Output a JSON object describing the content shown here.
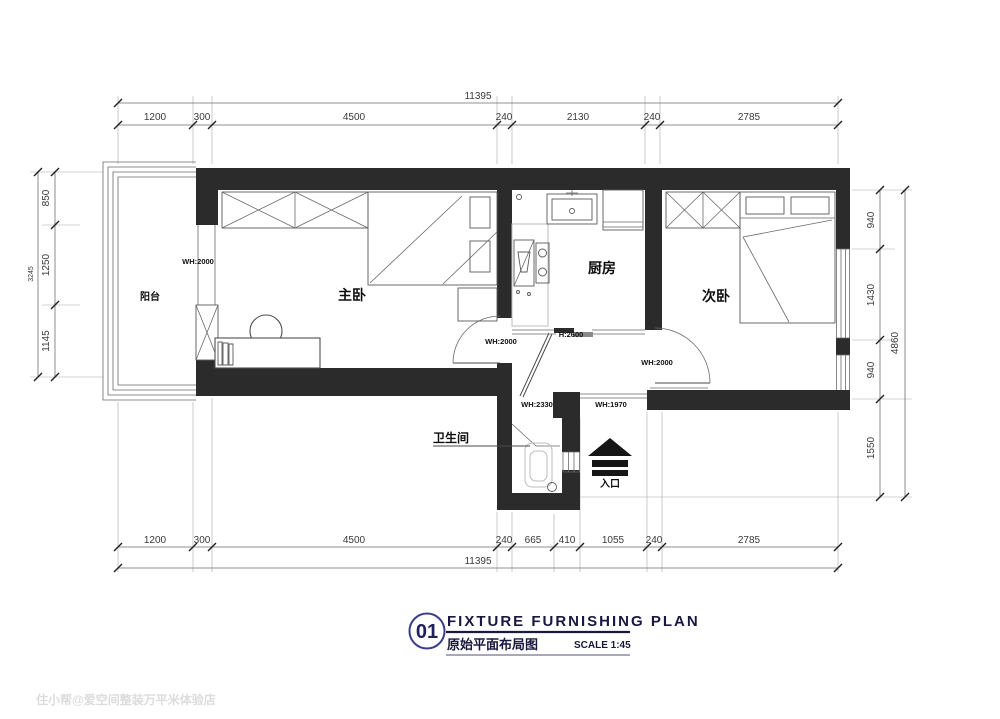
{
  "title_block": {
    "number": "01",
    "title_en": "FIXTURE FURNISHING PLAN",
    "title_zh": "原始平面布局图",
    "scale": "SCALE 1:45"
  },
  "watermark": "住小帮@爱空间整装万平米体验店",
  "rooms": {
    "balcony": "阳台",
    "master_bedroom": "主卧",
    "kitchen": "厨房",
    "second_bedroom": "次卧",
    "bathroom": "卫生间",
    "entrance": "入口"
  },
  "annotations": {
    "balcony_door": "WH:2000",
    "master_door": "WH:2000",
    "second_door": "WH:2000",
    "hall_height": "H:2600",
    "bath_door": "WH:2330",
    "entry_width": "WH:1970"
  },
  "dimensions": {
    "top": {
      "total": "11395",
      "segments": [
        "1200",
        "300",
        "4500",
        "240",
        "2130",
        "240",
        "2785"
      ]
    },
    "bottom": {
      "total": "11395",
      "segments": [
        "1200",
        "300",
        "4500",
        "240",
        "665",
        "410",
        "1055",
        "240",
        "2785"
      ]
    },
    "left": {
      "total": "3245",
      "segments": [
        "850",
        "1250",
        "1145"
      ]
    },
    "right": {
      "total": "4860",
      "segments": [
        "940",
        "1430",
        "940",
        "1550"
      ]
    }
  },
  "colors": {
    "wall": "#2b2b2b",
    "title_accent": "#20205e",
    "circle_accent": "#3d3d8e",
    "dim_text": "#3a3a3a",
    "watermark": "#dcdcdc"
  }
}
